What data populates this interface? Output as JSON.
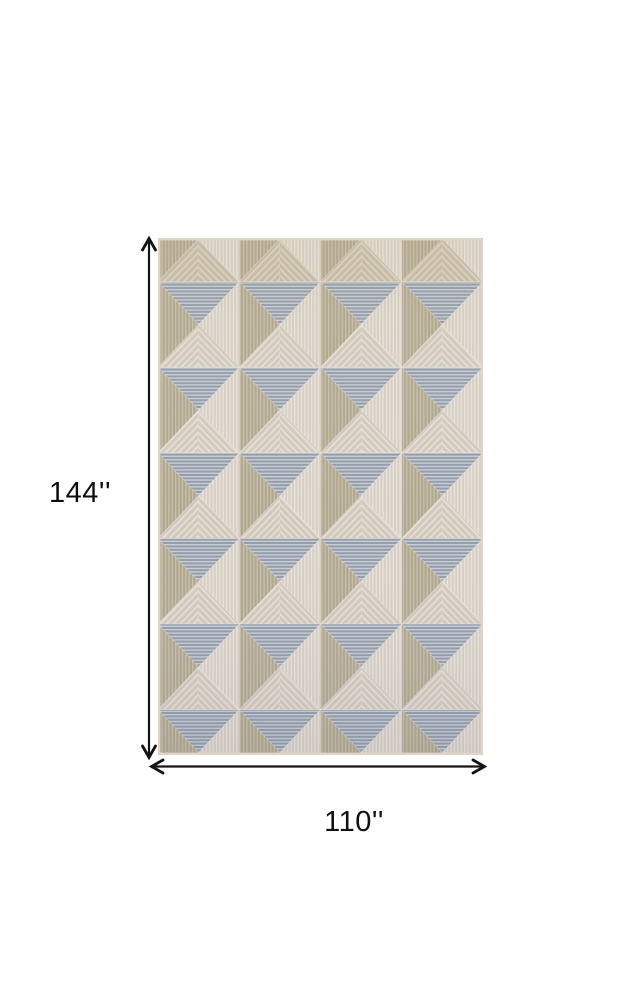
{
  "diagram": {
    "background_color": "#ffffff",
    "subject": "geometric-pyramid-pattern-rug"
  },
  "dimensions": {
    "height_label": "144''",
    "width_label": "110''",
    "unit": "inches",
    "arrow_color": "#141414",
    "label_color": "#0e0e0e"
  },
  "rug": {
    "columns": 4,
    "visible_row_units": 6,
    "tile_height": 85.6,
    "vertical_offset": -42,
    "edge_color": "#dcd5c8",
    "seam_color": "#f0eadf",
    "faces": {
      "north": {
        "base": "#939daa",
        "stripe": "#c7ccd4",
        "direction": "horizontal"
      },
      "east": {
        "base": "#d7cfc5",
        "stripe": "#e9e3da",
        "direction": "vertical"
      },
      "west": {
        "base": "#b0a78f",
        "stripe": "#c7beaa",
        "direction": "vertical"
      },
      "south": {
        "base": "#d3cabf",
        "stripe": "#e7e0d6",
        "direction": "chevron"
      },
      "top_band_south": {
        "base": "#c6bca9",
        "stripe": "#dcd3c2",
        "direction": "chevron"
      }
    },
    "tone_overlay": {
      "top": "#c8b690",
      "bottom": "#5a6a85"
    }
  }
}
